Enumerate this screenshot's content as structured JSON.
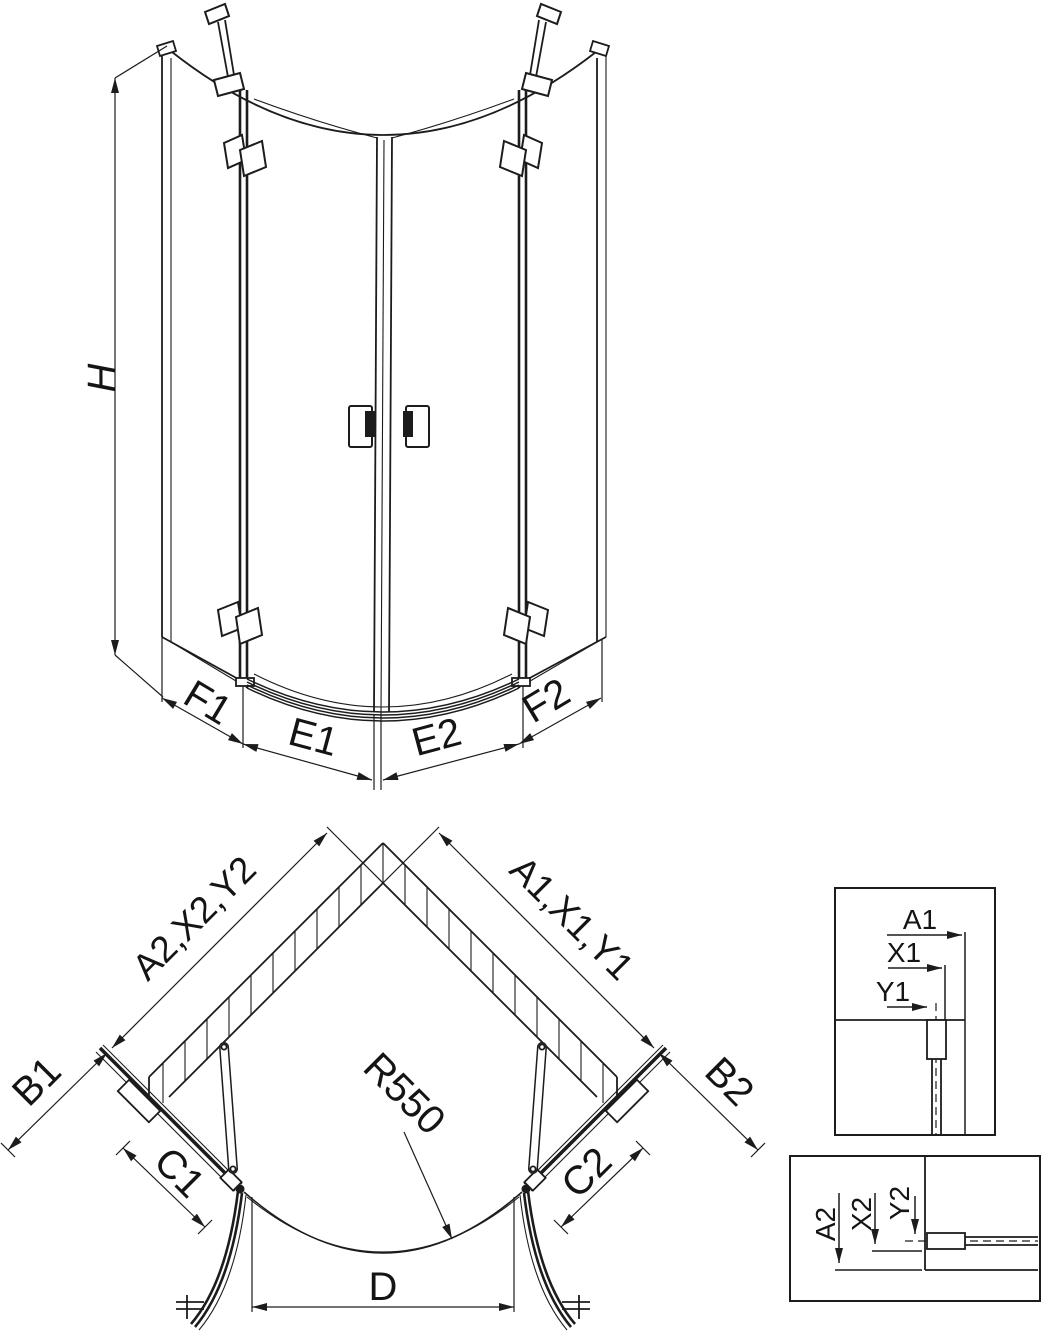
{
  "page": {
    "background": "#ffffff",
    "line_color": "#1c1c1c"
  },
  "elevation": {
    "height_label": "H",
    "dim_f1": "F1",
    "dim_e1": "E1",
    "dim_e2": "E2",
    "dim_f2": "F2"
  },
  "plan": {
    "dim_left_wall": "A2,X2,Y2",
    "dim_right_wall": "A1,X1,Y1",
    "dim_b1": "B1",
    "dim_b2": "B2",
    "dim_c1": "C1",
    "dim_c2": "C2",
    "dim_d": "D",
    "radius_label": "R550"
  },
  "detail_top": {
    "dim_a1": "A1",
    "dim_x1": "X1",
    "dim_y1": "Y1"
  },
  "detail_bottom": {
    "dim_a2": "A2",
    "dim_x2": "X2",
    "dim_y2": "Y2"
  }
}
